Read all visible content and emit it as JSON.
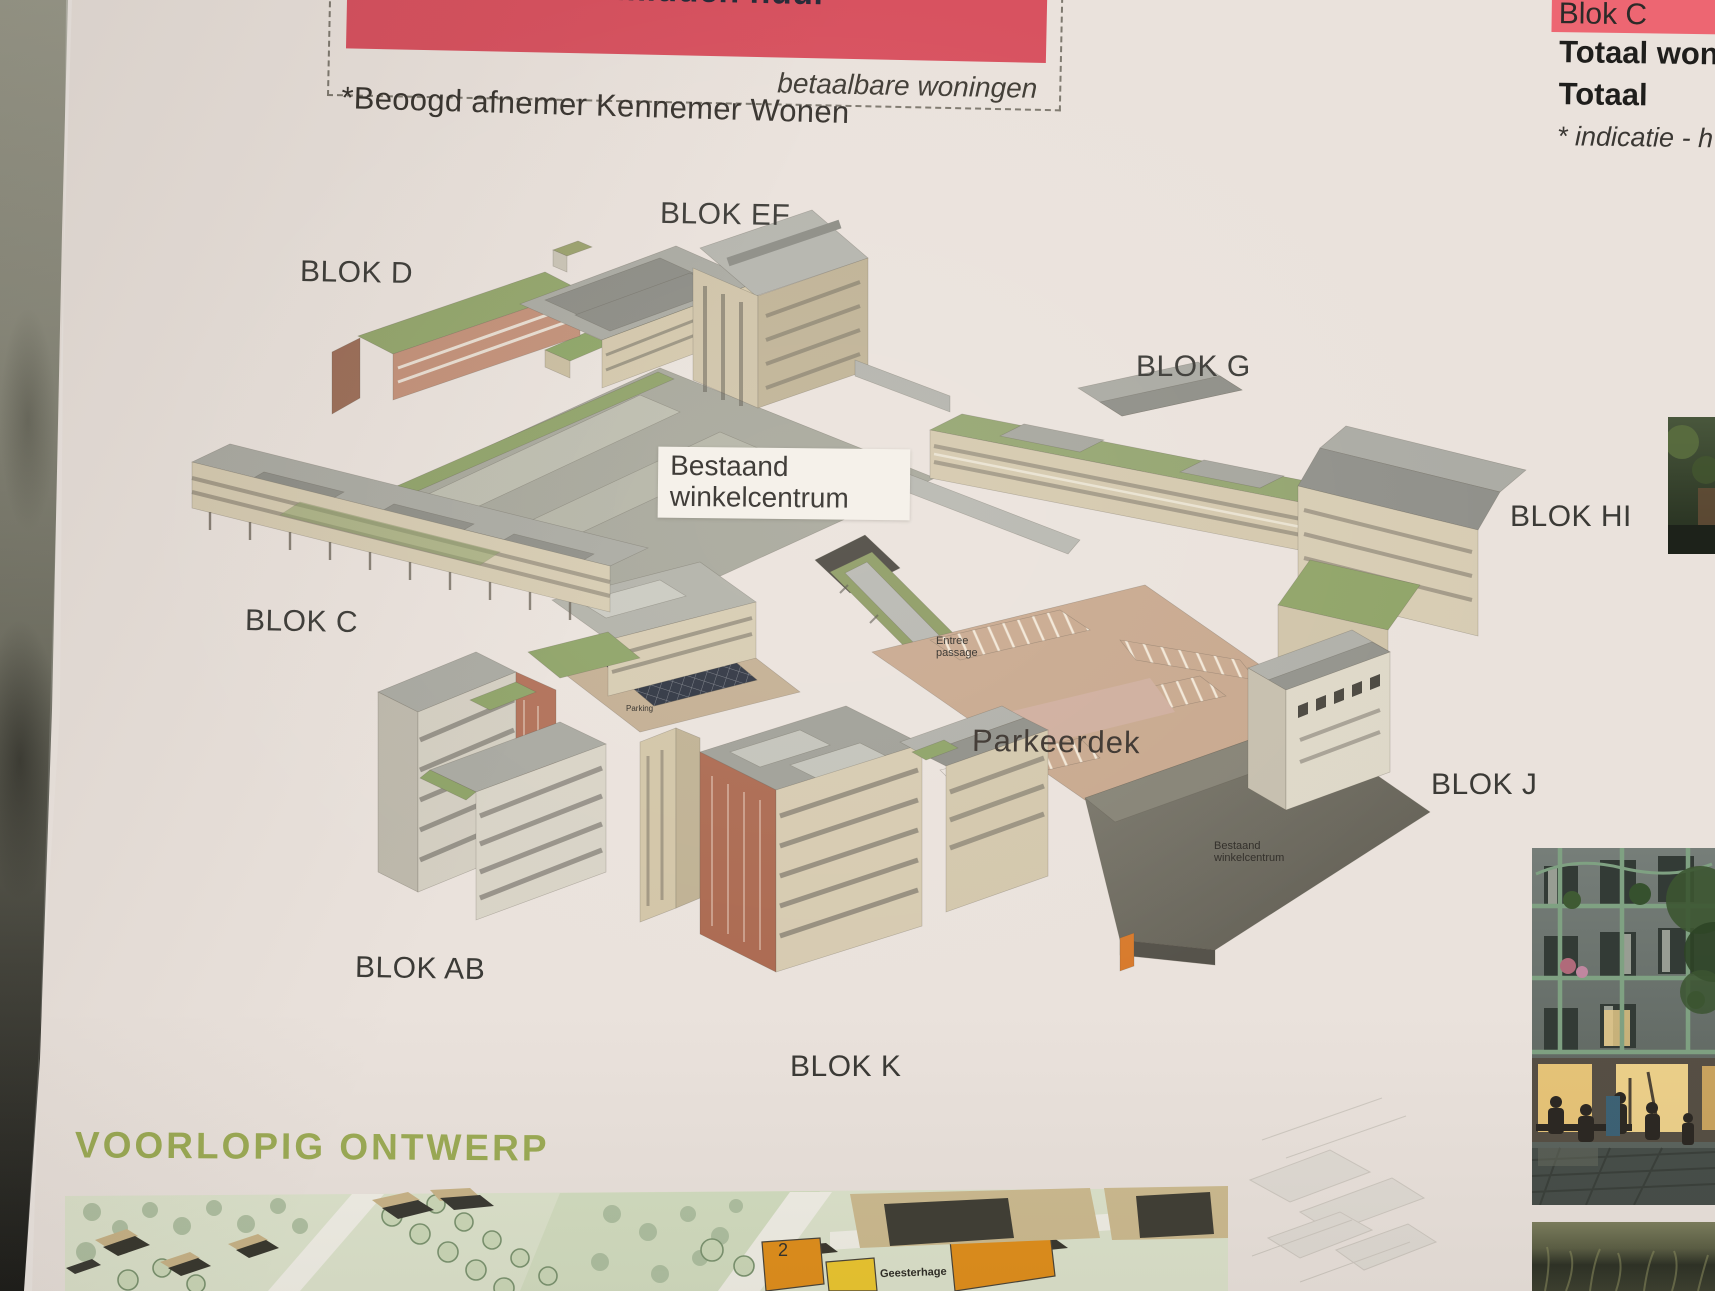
{
  "poster": {
    "program_box": {
      "banner_text": "90 midden huur",
      "banner_color": "#d8515f",
      "affordable_note": "betaalbare woningen",
      "footnote": "*Beoogd afnemer Kennemer Wonen"
    },
    "totals_table": {
      "highlight_row_label": "Blok C",
      "highlight_color": "#ed6672",
      "row_totaal_woningen": "Totaal woni",
      "row_totaal": "Totaal",
      "footnote": "* indicatie - h"
    },
    "axon_labels": {
      "blok_d": "BLOK D",
      "blok_ef": "BLOK EF",
      "blok_g": "BLOK G",
      "blok_hi": "BLOK HI",
      "blok_c": "BLOK C",
      "blok_j": "BLOK J",
      "blok_ab": "BLOK AB",
      "blok_k": "BLOK K",
      "bestaand_winkelcentrum_box": "Bestaand\nwinkelcentrum",
      "parkeerdek": "Parkeerdek",
      "entree_passage": "Entree\npassage",
      "bestaand_winkelcentrum_small": "Bestaand\nwinkelcentrum",
      "parking_small": "Parking"
    },
    "section_title": "VOORLOPIG ONTWERP",
    "section_title_color": "#9cab55",
    "map_labels": {
      "building_number": "2",
      "street_name": "Geesterhage"
    }
  }
}
